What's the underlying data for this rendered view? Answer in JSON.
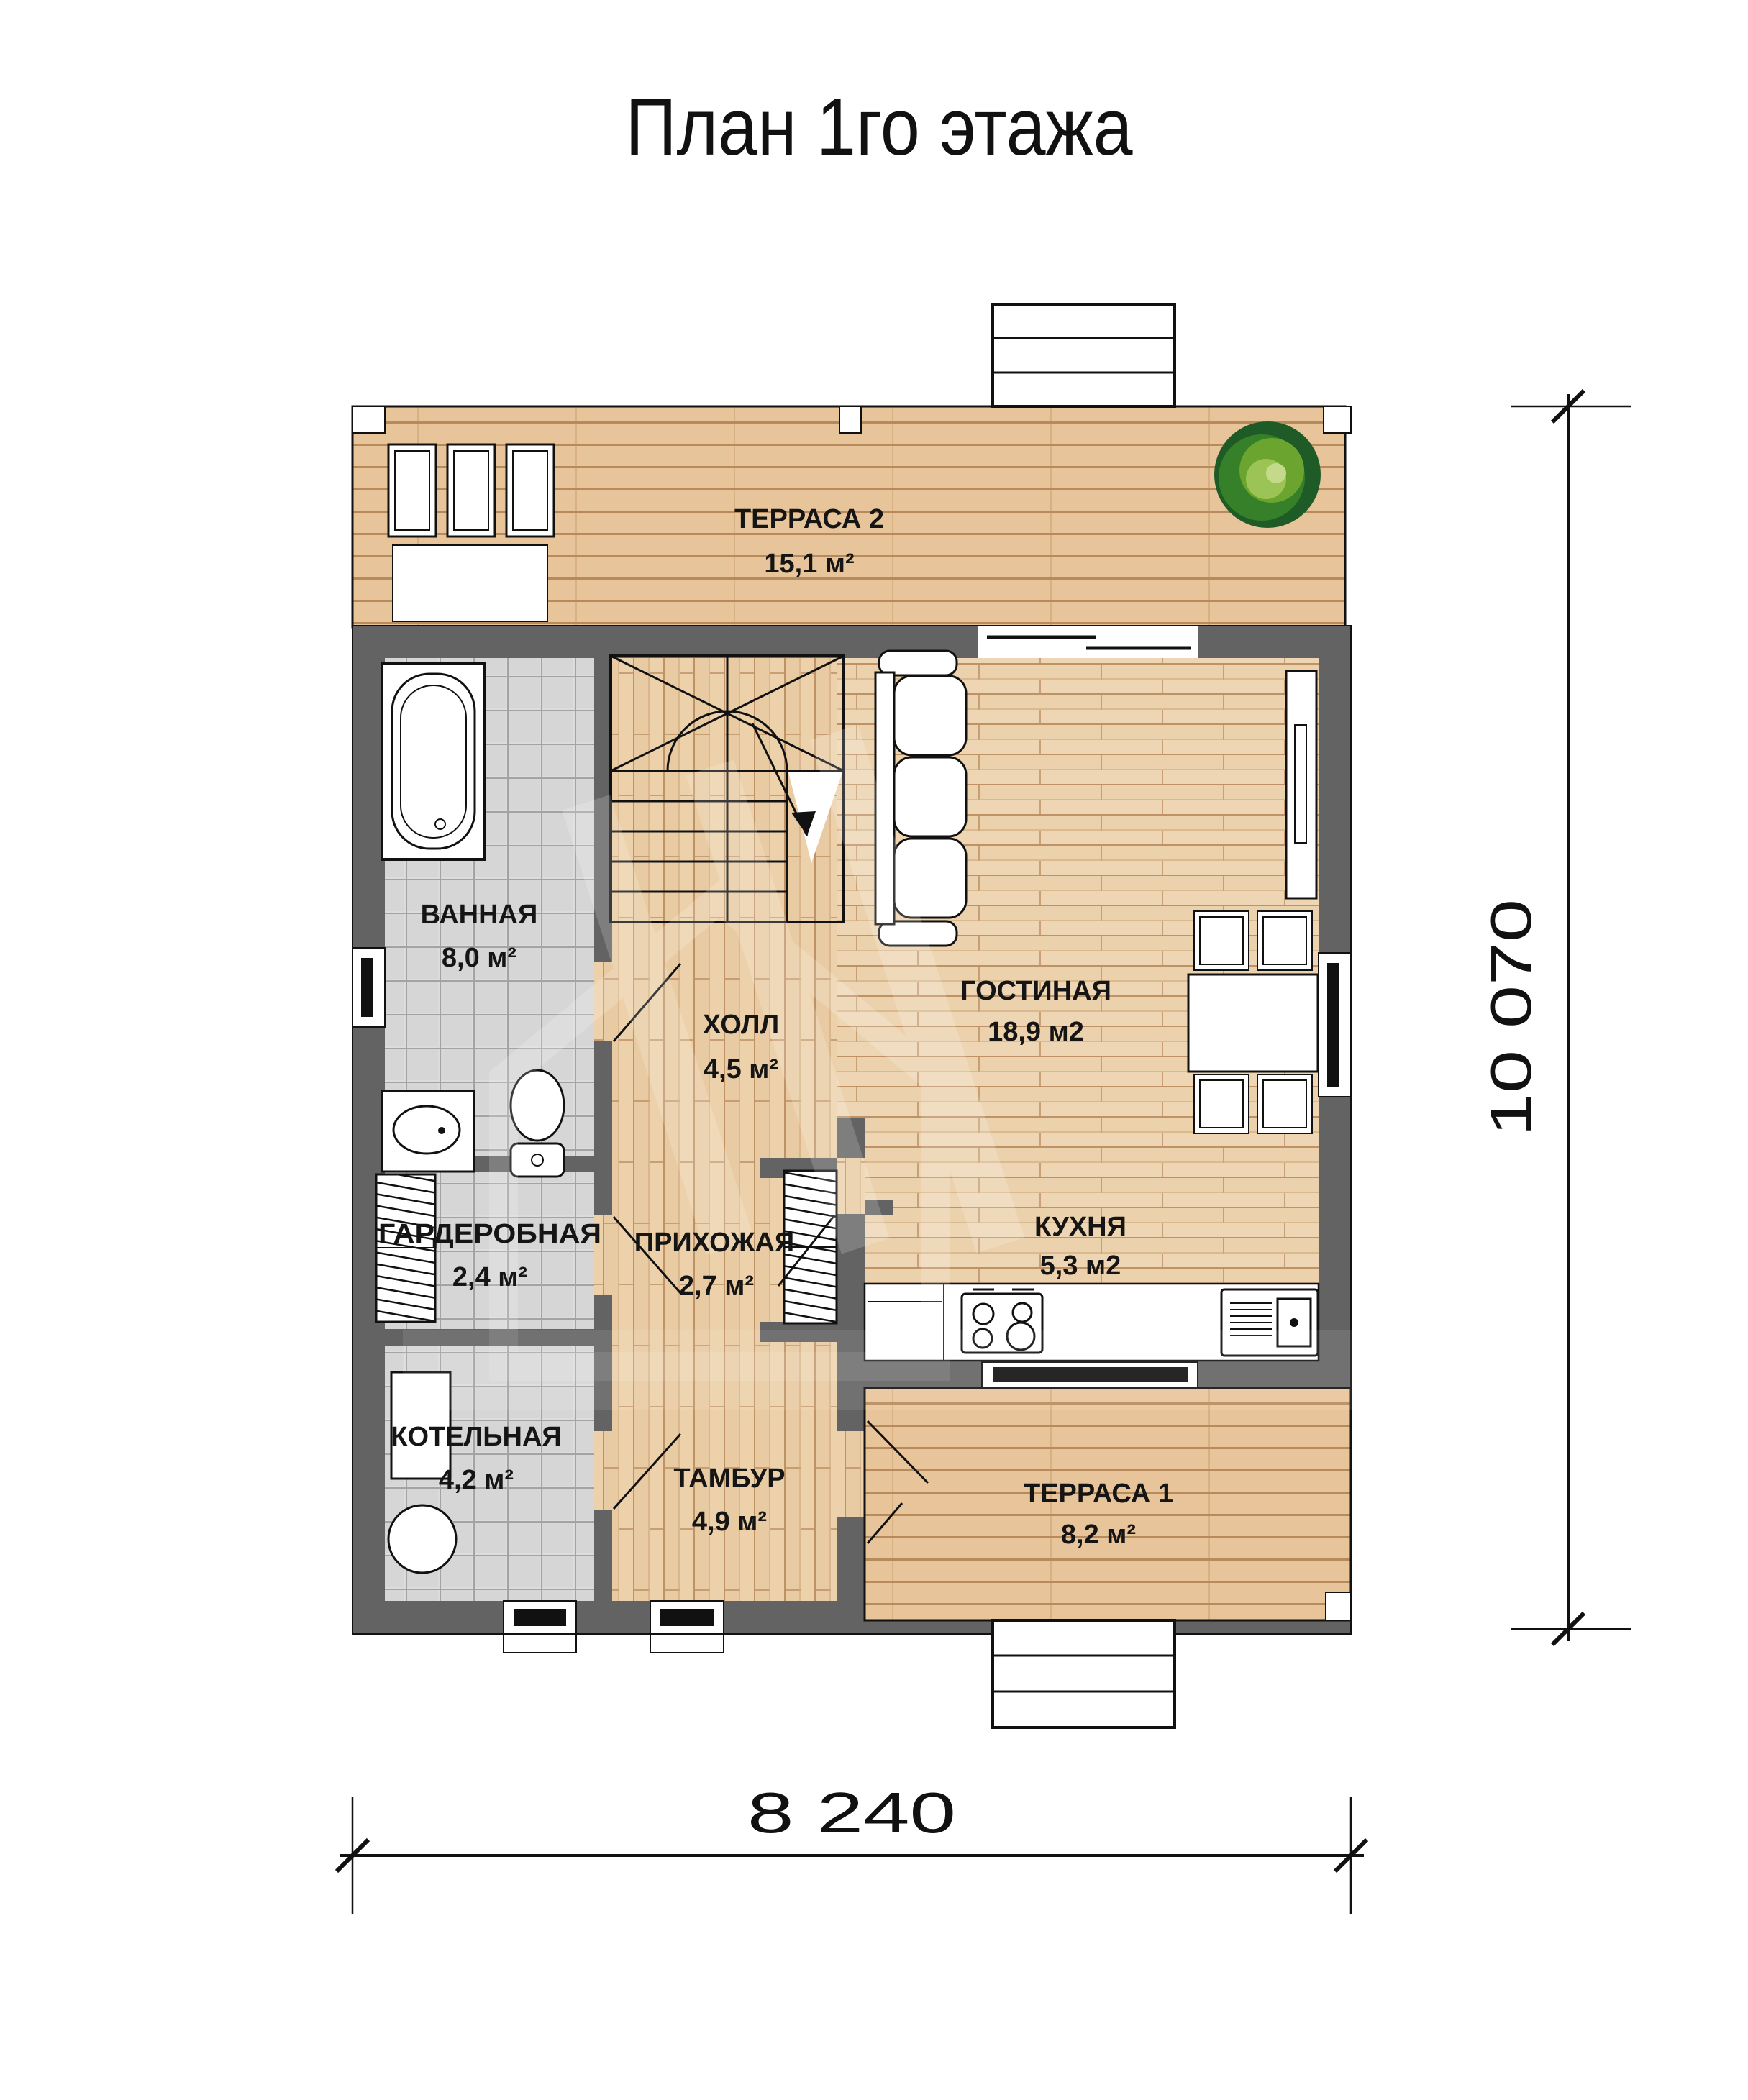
{
  "title": "План 1го этажа",
  "rooms": {
    "terrace2": {
      "name": "ТЕРРАСА 2",
      "area": "15,1 м²"
    },
    "bathroom": {
      "name": "ВАННАЯ",
      "area": "8,0 м²"
    },
    "hall": {
      "name": "ХОЛЛ",
      "area": "4,5 м²"
    },
    "living": {
      "name": "ГОСТИНАЯ",
      "area": "18,9 м2"
    },
    "wardrobe": {
      "name": "ГАРДЕРОБНАЯ",
      "area": "2,4 м²"
    },
    "hallway": {
      "name": "ПРИХОЖАЯ",
      "area": "2,7 м²"
    },
    "kitchen": {
      "name": "КУХНЯ",
      "area": "5,3 м2"
    },
    "boiler": {
      "name": "КОТЕЛЬНАЯ",
      "area": "4,2 м²"
    },
    "vestibule": {
      "name": "ТАМБУР",
      "area": "4,9 м²"
    },
    "terrace1": {
      "name": "ТЕРРАСА 1",
      "area": "8,2 м²"
    }
  },
  "dimensions": {
    "width_label": "8 240",
    "height_label": "10 070"
  },
  "colors": {
    "wall": "#636363",
    "terrace_wood": "#eac79e",
    "interior_wood": "#eed6b4",
    "tile": "#dcdcdc",
    "tree_green": "#37802a",
    "line": "#111111"
  }
}
